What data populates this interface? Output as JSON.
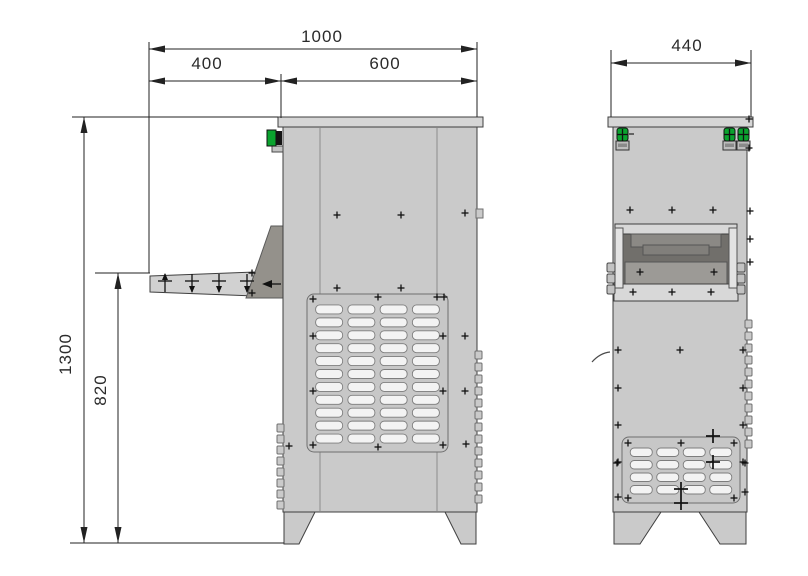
{
  "dimensions": {
    "side_view": {
      "total_width": "1000",
      "tray_width": "400",
      "body_width": "600",
      "total_height": "1300",
      "tray_height": "820"
    },
    "front_view": {
      "width": "440"
    }
  },
  "palette": {
    "background": "#ffffff",
    "outline": "#3f3f3f",
    "body_fill": "#cacaca",
    "cap_fill": "#d6d6d6",
    "seam": "#9e9e9e",
    "panel_fill": "#c7c7c7",
    "panel_stroke": "#6f6f6f",
    "louver_fill": "#f3f3f3",
    "louver_stroke": "#7d7d7d",
    "tray_fill": "#d1d1d1",
    "bracket_fill": "#94918b",
    "recess_dark": "#716f6b",
    "recess_mid": "#9c9a96",
    "bar_light": "#d8d8d8",
    "rail_light": "#e3e3e3",
    "bolt_fill": "#c2c2c2",
    "indicator_green": "#0aa32e",
    "screw": "#111111",
    "dim": "#222222"
  },
  "geometry": {
    "side_view": {
      "louver_panel": {
        "x": 307,
        "y": 294,
        "w": 141,
        "h": 158,
        "cols": 4,
        "rows": 11,
        "lw": 27,
        "lh": 9
      },
      "screws": [
        [
          337,
          215
        ],
        [
          401,
          215
        ],
        [
          465,
          213
        ],
        [
          337,
          288
        ],
        [
          401,
          288
        ],
        [
          313,
          299
        ],
        [
          378,
          297
        ],
        [
          437,
          297
        ],
        [
          444,
          297
        ],
        [
          313,
          336
        ],
        [
          443,
          336
        ],
        [
          465,
          336
        ],
        [
          313,
          391
        ],
        [
          443,
          391
        ],
        [
          465,
          391
        ],
        [
          313,
          445
        ],
        [
          378,
          447
        ],
        [
          443,
          445
        ],
        [
          289,
          446
        ],
        [
          466,
          444
        ],
        [
          252,
          273
        ],
        [
          252,
          293
        ]
      ],
      "bumps_left": {
        "x": 277,
        "y0": 424,
        "count": 8,
        "pitch": 11
      },
      "bumps_right": {
        "x": 475,
        "y0": 351,
        "count": 13,
        "pitch": 12
      },
      "tray_symbols_x": [
        165,
        192,
        219,
        247
      ],
      "tray_symbols_y": 283
    },
    "front_view": {
      "louver_panel": {
        "x": 622,
        "y": 437,
        "w": 118,
        "h": 66,
        "cols": 4,
        "rows": 4,
        "lw": 22,
        "lh": 8.5
      },
      "screws": [
        [
          630,
          210
        ],
        [
          672,
          210
        ],
        [
          713,
          210
        ],
        [
          640,
          272
        ],
        [
          714,
          272
        ],
        [
          633,
          292
        ],
        [
          672,
          292
        ],
        [
          711,
          292
        ],
        [
          618,
          350
        ],
        [
          680,
          350
        ],
        [
          743,
          350
        ],
        [
          618,
          388
        ],
        [
          743,
          388
        ],
        [
          618,
          425
        ],
        [
          743,
          425
        ],
        [
          618,
          462
        ],
        [
          743,
          462
        ],
        [
          618,
          497
        ],
        [
          628,
          443
        ],
        [
          681,
          443
        ],
        [
          734,
          443
        ],
        [
          628,
          498
        ],
        [
          734,
          498
        ],
        [
          617,
          463
        ],
        [
          745,
          463
        ],
        [
          745,
          492
        ],
        [
          749,
          119
        ],
        [
          749,
          148
        ],
        [
          750,
          211
        ],
        [
          750,
          239
        ],
        [
          750,
          262
        ]
      ],
      "big_crosses": [
        [
          713,
          436
        ],
        [
          713,
          462
        ],
        [
          681,
          489
        ],
        [
          681,
          503
        ]
      ],
      "bumps_right": {
        "x": 745,
        "y0": 320,
        "count": 11,
        "pitch": 12
      }
    }
  }
}
